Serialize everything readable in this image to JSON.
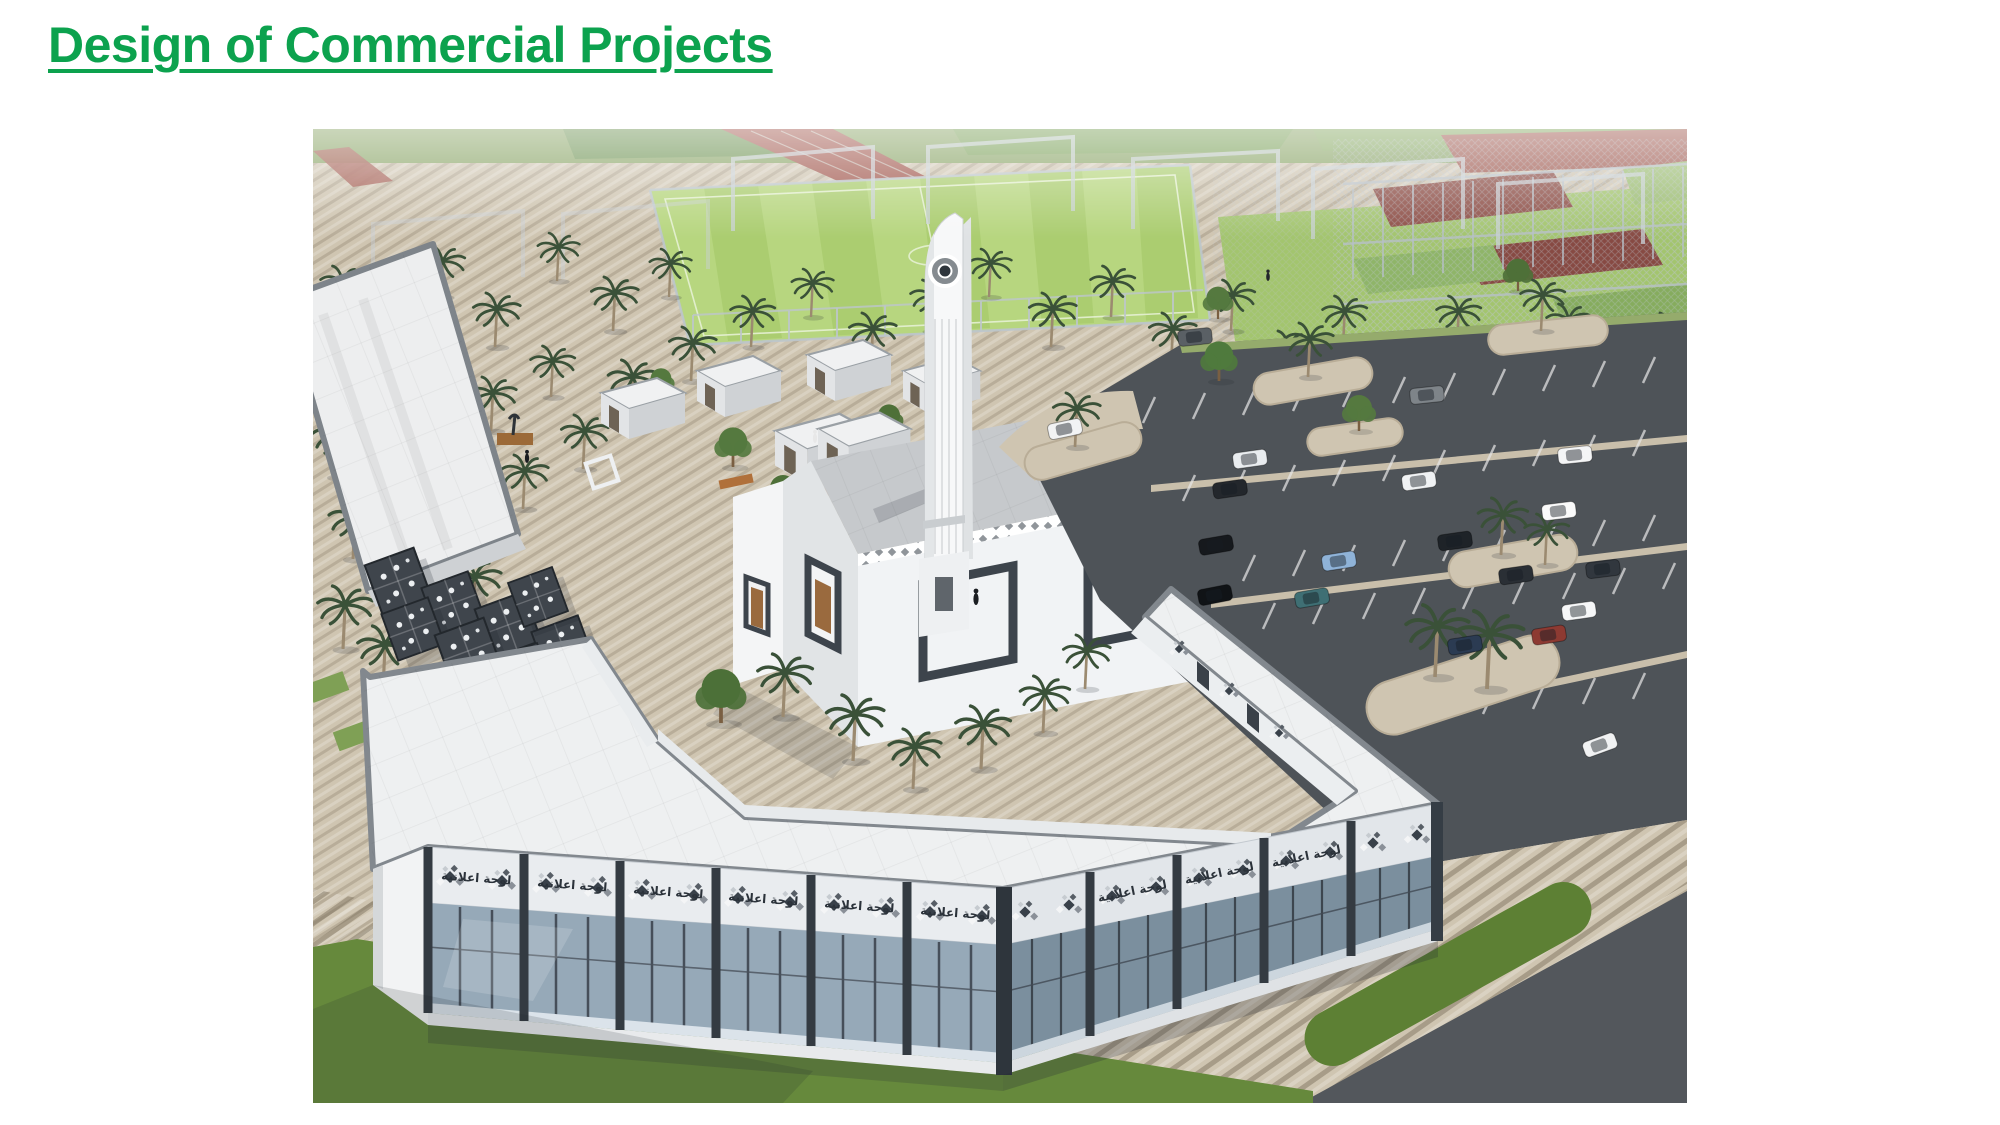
{
  "slide": {
    "title": "Design of Commercial Projects",
    "title_color": "#0CA24E",
    "background": "#FFFFFF"
  },
  "render": {
    "signage_text": "لوحة اعلانية",
    "colors": {
      "plaza_pavers": "#CFC5B1",
      "asphalt": "#4E5358",
      "soccer_field_green": "#B7D67F",
      "court_green": "#A3C56E",
      "track_red": "#A35B51",
      "grass": "#66893C",
      "building_white": "#EFF1F2",
      "roof_slab_gray": "#C7CACD",
      "trim_dark": "#39414A",
      "storefront_glass": "#93A7B6",
      "palm_foliage": "#3A5138"
    }
  }
}
